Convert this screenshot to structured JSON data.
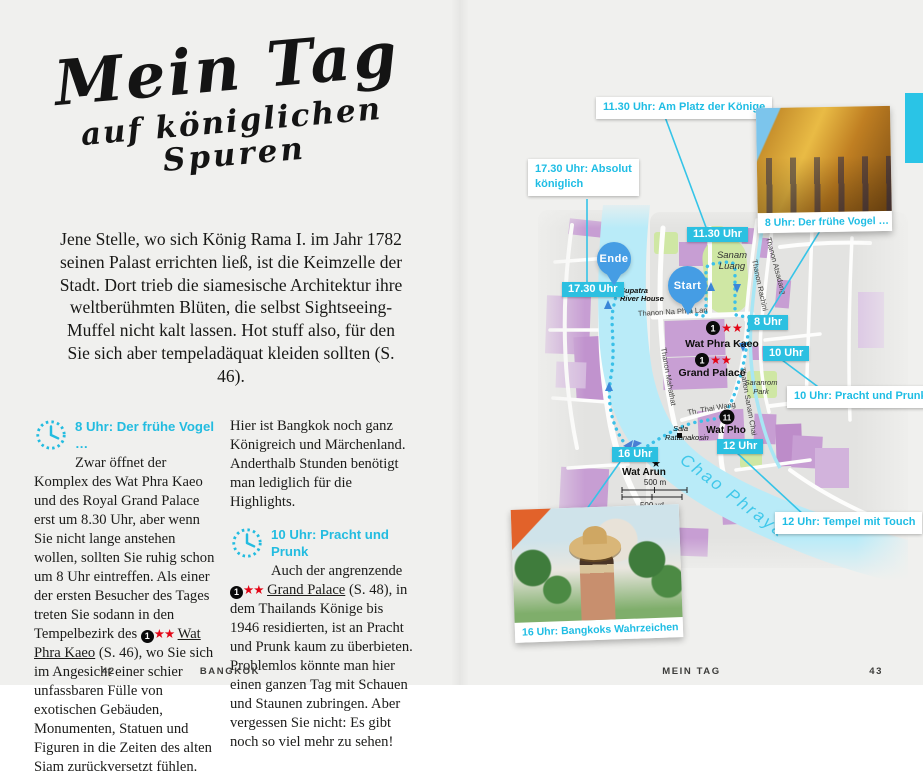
{
  "palette": {
    "cyan": "#2cc0e1",
    "pin_blue": "#459de4",
    "star_red": "#e30617",
    "building_purple": "#c79ed3",
    "park_green": "#cfe7a4",
    "river_cyan": "#b9ebf8"
  },
  "left_page": {
    "title": {
      "line1": "Mein Tag",
      "line2": "auf königlichen",
      "line3": "Spuren"
    },
    "intro": "Jene Stelle, wo sich König Rama I. im Jahr 1782 seinen Palast errichten ließ, ist die Keimzelle der Stadt. Dort trieb die siamesische Architektur ihre weltberühmten Blüten, die selbst Sightseeing-Muffel nicht kalt lassen. Hot stuff also, für den Sie sich aber tempeladäquat kleiden sollten (S. 46).",
    "section1": {
      "heading": "8 Uhr: Der frühe Vogel …",
      "body_before": "Zwar öffnet der Komplex des Wat Phra Kaeo und des Royal Grand Palace erst um 8.30 Uhr, aber wenn Sie nicht lange anstehen wollen, sollten Sie ruhig schon um 8 Uhr eintreffen. Als einer der ersten Besucher des Tages treten Sie sodann in den Tempelbezirk des",
      "marker": "1",
      "stars": "★★",
      "link": "Wat Phra Kaeo",
      "body_after": "(S. 46), wo Sie sich im Angesicht einer schier unfassbaren Fülle von exotischen Gebäuden, Monumenten, Statuen und Figuren in die Zeiten des alten Siam zurückversetzt fühlen."
    },
    "section2": {
      "lead_para": "Hier ist Bangkok noch ganz Königreich und Märchenland. Anderthalb Stunden benötigt man lediglich für die Highlights.",
      "heading": "10 Uhr: Pracht und Prunk",
      "body_before": "Auch der angrenzende",
      "marker": "1",
      "stars": "★★",
      "link": "Grand Palace",
      "body_after": "(S. 48), in dem Thailands Könige bis 1946 residierten, ist an Pracht und Prunk kaum zu überbieten. Problemlos könnte man hier einen ganzen Tag mit Schauen und Staunen zubringen. Aber vergessen Sie nicht: Es gibt noch so viel mehr zu sehen!"
    },
    "footer": {
      "page_number": "42",
      "label": "BANGKOK"
    }
  },
  "right_page": {
    "footer": {
      "label": "MEIN TAG",
      "page_number": "43"
    },
    "callouts": {
      "c1130": "11.30 Uhr: Am Platz der Könige",
      "c1730_line1": "17.30 Uhr: Absolut",
      "c1730_line2": "königlich",
      "c10": "10 Uhr: Pracht und Prunk",
      "c12": "12 Uhr: Tempel mit Touch"
    },
    "photo_top_caption": "8 Uhr: Der frühe Vogel …",
    "photo_bottom_caption": "16 Uhr: Bangkoks Wahrzeichen",
    "time_boxes": {
      "t1130": "11.30 Uhr",
      "t1730": "17.30 Uhr",
      "t8": "8 Uhr",
      "t10": "10 Uhr",
      "t12": "12 Uhr",
      "t16": "16 Uhr"
    },
    "pins": {
      "start": "Start",
      "end": "Ende"
    },
    "map": {
      "pois": {
        "wat_phra_kaeo": "Wat Phra Kaeo",
        "grand_palace": "Grand Palace",
        "wat_pho": "Wat Pho",
        "wat_arun": "Wat Arun",
        "palace_marker_number": "1",
        "wat_pho_marker_number": "11",
        "stars_two": "★★",
        "star_one": "★",
        "supatra_line1": "Supatra",
        "supatra_line2": "River House",
        "sala_line1": "Sala",
        "sala_line2": "Rattanakosin",
        "sanam_line1": "Sanam",
        "sanam_line2": "Luang",
        "saranrom_line1": "Saranrom",
        "saranrom_line2": "Park",
        "river": "Chao Phraya"
      },
      "streets": {
        "na_phra_lan": "Thanon Na Phra Lan",
        "atsadang": "Thanon Atsadang",
        "rachini": "Thanon Rachini",
        "mahathat": "Thanon Mahathat",
        "sanam_chai": "Thanon Sanam Chai",
        "thai_wang": "Th. Thai Wang"
      },
      "scale": {
        "metric": "500 m",
        "imperial": "500 yd"
      }
    }
  }
}
